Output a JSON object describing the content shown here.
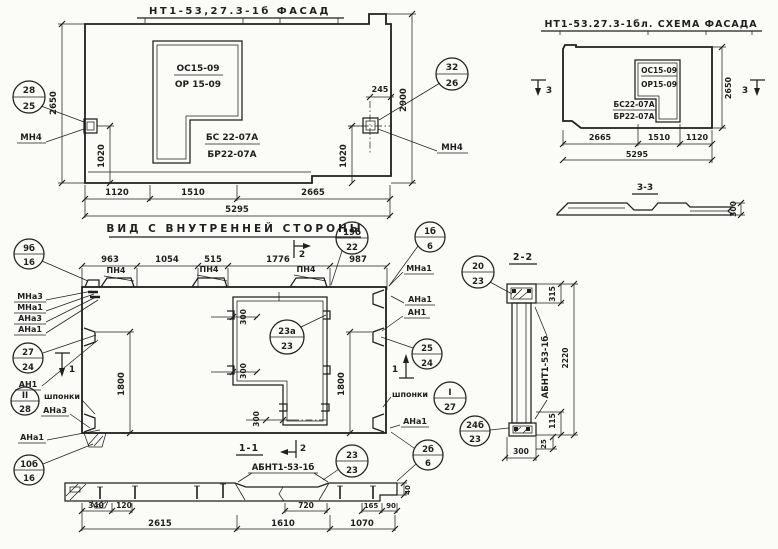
{
  "facade": {
    "title": "НТ1-53,27.3-1б ФАСАД",
    "opening": {
      "top": "ОС15-09",
      "bottom": "ОР 15-09"
    },
    "sill": {
      "top": "БС 22-07А",
      "bottom": "БР22-07А"
    },
    "dims": {
      "w1": "1120",
      "w2": "1510",
      "w3": "2665",
      "total": "5295",
      "h_left": "2650",
      "v_left": "1020",
      "h_right": "2900",
      "v_right": "1020",
      "anchor": "245"
    },
    "balloons": {
      "left": {
        "top": "28",
        "bot": "25"
      },
      "right": {
        "top": "32",
        "bot": "26"
      }
    },
    "anchor_left": "МН4",
    "anchor_right": "МН4"
  },
  "scheme": {
    "title": "НТ1-53.27.3-1бл. СХЕМА ФАСАДА",
    "opening": {
      "top": "ОС15-09",
      "bottom": "ОР15-09"
    },
    "sill": {
      "top": "БС22-07А",
      "bottom": "БР22-07А"
    },
    "dims": {
      "w1": "2665",
      "w2": "1510",
      "w3": "1120",
      "total": "5295",
      "h_right": "2650",
      "depth": "300"
    },
    "cut_label": "3",
    "section_title": "3-3"
  },
  "inner": {
    "title": "ВИД С ВНУТРЕННЕЙ СТОРОНЫ",
    "dims": {
      "t1": "963",
      "t2": "1054",
      "t3": "515",
      "t4": "1776",
      "t5": "987",
      "h_left": "1800",
      "h_right": "1800",
      "o1": "300",
      "o2": "300",
      "o3": "300"
    },
    "loop_label": "ПН4",
    "cut1": "1",
    "cut2": "2",
    "left_labels": {
      "l1": "МНа3",
      "l2": "МНа1",
      "l3": "АНа3",
      "l4": "АНа1",
      "l5": "АН1",
      "l6": "шпонки",
      "l7": "АНа3",
      "l8": "АНа1"
    },
    "right_labels": {
      "r1": "МНа1",
      "r2": "АНа1",
      "r3": "АН1",
      "r4": "шпонки",
      "r5": "АНа1"
    },
    "balloons": {
      "b9": {
        "top": "9б",
        "bot": "16"
      },
      "b19": {
        "top": "19б",
        "bot": "22"
      },
      "b1": {
        "top": "1б",
        "bot": "6"
      },
      "b27": {
        "top": "27",
        "bot": "24"
      },
      "b28": {
        "top": "II",
        "bot": "28"
      },
      "b10": {
        "top": "10б",
        "bot": "16"
      },
      "b25": {
        "top": "25",
        "bot": "24"
      },
      "bI": {
        "top": "I",
        "bot": "27"
      },
      "b2b": {
        "top": "2б",
        "bot": "6"
      },
      "b23a": {
        "top": "23а",
        "bot": "23"
      }
    },
    "section_title": "1-1"
  },
  "section11": {
    "beam_label": "АБНТ1-53-1б",
    "dims": {
      "a": "340",
      "b": "120",
      "c": "2615",
      "d": "720",
      "e": "1610",
      "f": "165",
      "g": "90",
      "h": "1070",
      "t": "40"
    },
    "balloons": {
      "b23": {
        "top": "23",
        "bot": "23"
      }
    }
  },
  "section22": {
    "title": "2-2",
    "beam_label": "АБНТ1-53-1б",
    "dims": {
      "top": "315",
      "height": "2220",
      "low": "115",
      "off": "25",
      "width": "300"
    },
    "balloons": {
      "b20": {
        "top": "20",
        "bot": "23"
      },
      "b24": {
        "top": "24б",
        "bot": "23"
      }
    }
  }
}
